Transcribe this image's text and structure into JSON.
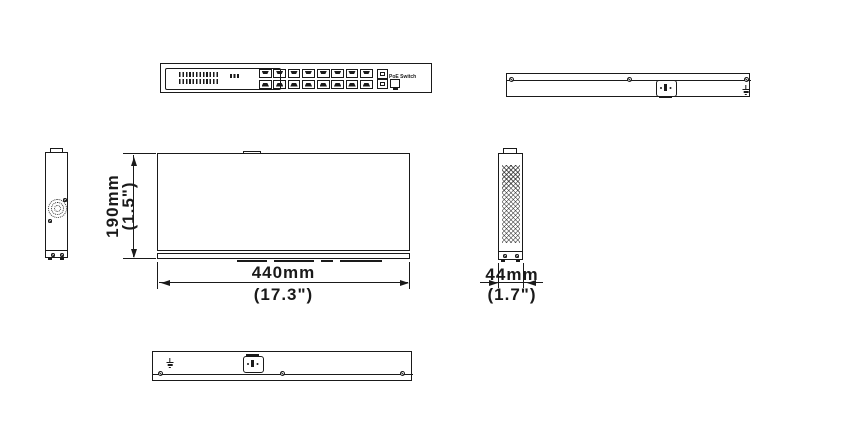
{
  "drawing_title": "PoE Switch dimension drawing",
  "front_panel": {
    "label": "PoE Switch",
    "rj45_ports": 16,
    "port_groups": 2,
    "sfp_ports": 2
  },
  "dims": {
    "height_mm": "190mm",
    "height_in": "(1.5\")",
    "width_mm": "440mm",
    "width_in": "(17.3\")",
    "depth_mm": "44mm",
    "depth_in": "(1.7\")"
  },
  "colors": {
    "line": "#1a1a1a",
    "background": "#ffffff"
  }
}
